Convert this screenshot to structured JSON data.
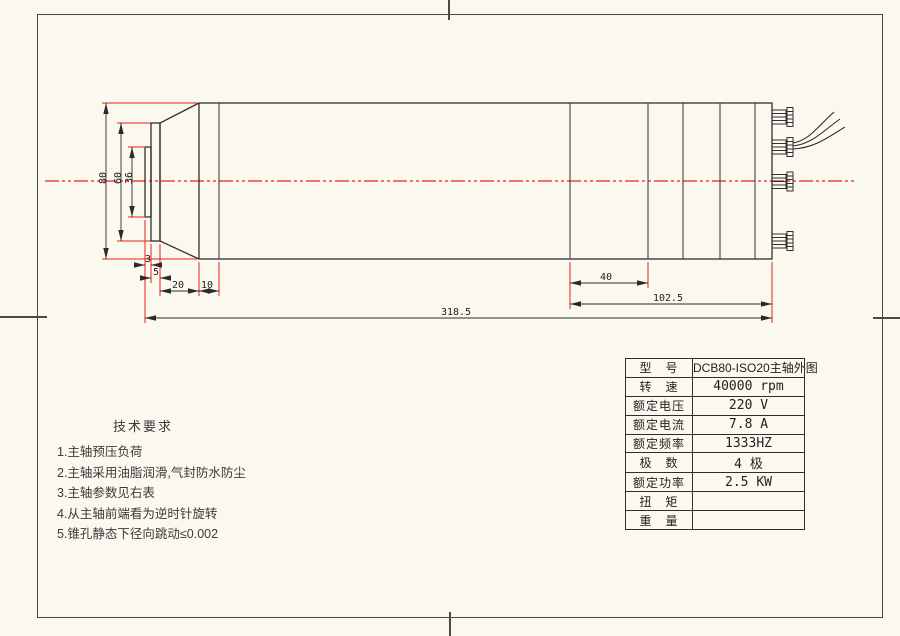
{
  "page": {
    "background": "#faf8ef",
    "line_color": "#303030",
    "accent_red": "#ee2114"
  },
  "dimensions": {
    "diameter_outer": "80",
    "diameter_collar": "60",
    "diameter_nose": "36",
    "nose_disc_width": "3",
    "collar_width": "5",
    "taper_length": "20",
    "step_length": "10",
    "rear_section_length": "40",
    "rear_block_length": "102.5",
    "total_length": "318.5"
  },
  "tech_requirements": {
    "title": "技术要求",
    "items": [
      "1.主轴预压负荷",
      "2.主轴采用油脂润滑,气封防水防尘",
      "3.主轴参数见右表",
      "4.从主轴前端看为逆时针旋转",
      "5.锥孔静态下径向跳动≤0.002"
    ]
  },
  "spec_table": {
    "rows": [
      {
        "label": "型　号",
        "value": "DCB80-ISO20主轴外图"
      },
      {
        "label": "转　速",
        "value": "40000 rpm"
      },
      {
        "label": "额定电压",
        "value": "220 V"
      },
      {
        "label": "额定电流",
        "value": "7.8 A"
      },
      {
        "label": "额定频率",
        "value": "1333HZ"
      },
      {
        "label": "极　数",
        "value": "4 极"
      },
      {
        "label": "额定功率",
        "value": "2.5 KW"
      },
      {
        "label": "扭　矩",
        "value": ""
      },
      {
        "label": "重　量",
        "value": ""
      }
    ]
  }
}
